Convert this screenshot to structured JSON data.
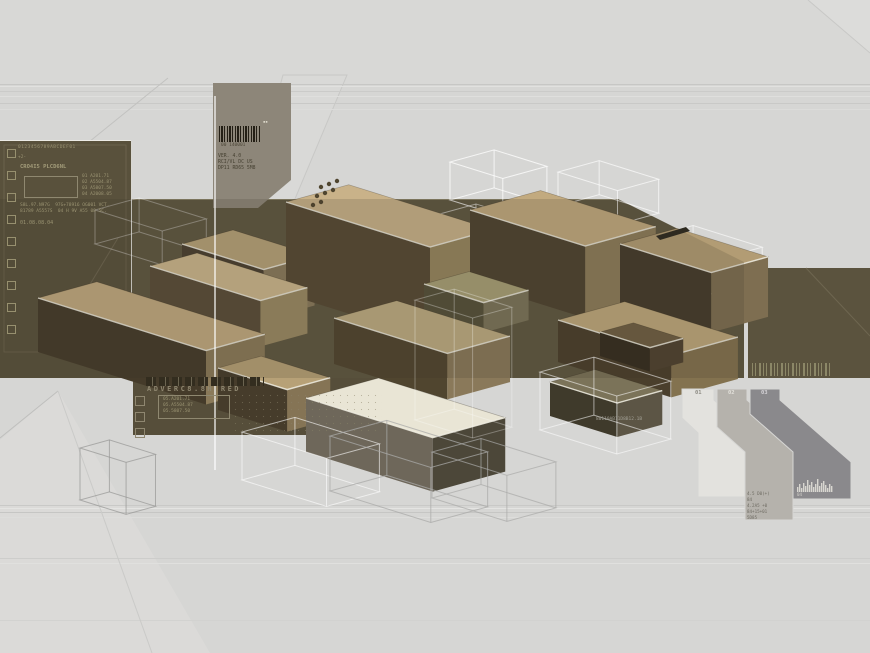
{
  "palette": {
    "background": "#d6d6d4",
    "band_olive": "#5f5741",
    "panel_olive": "#59513c",
    "block_tan": "#c9b289",
    "block_cream": "#e9e5d5",
    "block_front_dark": "#473d2a",
    "annotation_ink": "#9a9372",
    "taupe_box": "#8d8679"
  },
  "left_panel": {
    "digits": "0123456789ABCDEF01",
    "plus": "+2-",
    "title": "CRO4I5 PLCD6NL",
    "diagram_labels": [
      "01 A201.71",
      "02 A5504.87",
      "03 A5807.50",
      "04 A2008.05"
    ],
    "body_line1": "S8L.97.N97G  97G+78916 OG001 VCT.",
    "body_line2": "81789 A5557S  04 H 9V A55 08 5C.",
    "date_code": "01.08.08.04",
    "checkboxes": {
      "x": 7,
      "y": 149,
      "size": 7,
      "gap": 22,
      "count": 9,
      "color": "#97906f"
    }
  },
  "barcode_box": {
    "code": "00 140001",
    "tm_marks": "▪▪",
    "lines": [
      "VER. 4.0",
      "RCI/VL DC US",
      "DP11 RD65 5M8"
    ]
  },
  "lower_panel": {
    "title": "ADVERC8.8H RED",
    "box_lines": [
      "05.A201.71",
      "05.A5504.87",
      "05.5807.50"
    ],
    "checkboxes": {
      "x": 135,
      "y": 396,
      "size": 8,
      "gap": 16,
      "count": 3,
      "color": "#8f8770"
    }
  },
  "serial_text": "80110AB11D8B12.1B",
  "banners": {
    "labels": [
      "01",
      "02",
      "03"
    ],
    "label_colors": [
      "#8f8d85",
      "#e2e0da",
      "#d4d2d6"
    ],
    "text_lines": [
      "4.5 D0(+)",
      "84",
      "4.2A5 +0",
      "84+15+01",
      "5D85"
    ],
    "hist_label": "04"
  },
  "scene": {
    "iso": {
      "ax": 0.96,
      "ay": 0.3,
      "bx": 0.98,
      "by": -0.27
    },
    "top_rect": {
      "pts": [
        [
          0,
          0
        ],
        [
          870,
          0
        ],
        [
          870,
          84
        ],
        [
          0,
          84
        ]
      ],
      "fill": "#d8d8d6"
    },
    "wedges": [
      {
        "pts": [
          [
            0,
            653
          ],
          [
            0,
            440
          ],
          [
            58,
            391
          ],
          [
            210,
            653
          ]
        ],
        "fill": "#dbdad8"
      },
      {
        "pts": [
          [
            808,
            0
          ],
          [
            870,
            0
          ],
          [
            870,
            53
          ]
        ],
        "fill": "#dcdcda"
      },
      {
        "pts": [
          [
            283,
            75
          ],
          [
            347,
            75
          ],
          [
            292,
            206
          ],
          [
            247,
            206
          ]
        ],
        "fill": "#d9d9d7",
        "stroke": "#c8c8c6"
      }
    ],
    "stripes": [
      {
        "y": 84,
        "c": "#c7c7c5"
      },
      {
        "y": 86,
        "c": "#e1e1df"
      },
      {
        "y": 91,
        "c": "#cbcbc9"
      },
      {
        "y": 96,
        "c": "#dfdfdd"
      },
      {
        "y": 103,
        "c": "#c9c9c7"
      },
      {
        "y": 109,
        "c": "#dcdcda"
      },
      {
        "y": 505,
        "c": "#c9c9c7"
      },
      {
        "y": 508,
        "c": "#e4e4e2"
      },
      {
        "y": 512,
        "c": "#c6c6c4"
      },
      {
        "y": 517,
        "c": "#dddddb"
      },
      {
        "y": 558,
        "c": "#cdcdcb"
      },
      {
        "y": 563,
        "c": "#e0e0de"
      },
      {
        "y": 620,
        "c": "#d2d2d0"
      }
    ],
    "lines": [
      {
        "x1": 168,
        "y1": 78,
        "x2": 0,
        "y2": 214,
        "c": "#c2c2c0",
        "w": 1
      },
      {
        "x1": 0,
        "y1": 438,
        "x2": 58,
        "y2": 391,
        "c": "#bfbfbd",
        "w": 1
      },
      {
        "x1": 58,
        "y1": 391,
        "x2": 152,
        "y2": 653,
        "c": "#cacac8",
        "w": 1
      },
      {
        "x1": 808,
        "y1": 0,
        "x2": 870,
        "y2": 53,
        "c": "#c8c8c6",
        "w": 1
      }
    ],
    "left_panel": {
      "x": 0,
      "y": 141,
      "w": 131,
      "h": 237,
      "fill": "#59513c",
      "edge": "#ecebe5",
      "inner": "#6e6650",
      "diag": [
        [
          118,
          238
        ],
        [
          60,
          334
        ]
      ]
    },
    "band": {
      "pts": [
        [
          0,
          199
        ],
        [
          618,
          199
        ],
        [
          744,
          262
        ],
        [
          744,
          378
        ],
        [
          0,
          378
        ]
      ],
      "fill": "#5f5741",
      "top_edge": "#8a8268"
    },
    "lower_panel": {
      "pts": [
        [
          133,
          378
        ],
        [
          430,
          378
        ],
        [
          352,
          435
        ],
        [
          133,
          435
        ]
      ],
      "fill": "#564e3a"
    },
    "right_rect": {
      "x": 748,
      "y": 268,
      "w": 122,
      "h": 110,
      "fill": "#5b533e",
      "diag": [
        [
          806,
          268
        ],
        [
          870,
          336
        ]
      ]
    },
    "barcode_box": {
      "pts": [
        [
          213,
          83
        ],
        [
          291,
          83
        ],
        [
          291,
          180
        ],
        [
          258,
          208
        ],
        [
          213,
          208
        ]
      ],
      "fill": "#8d8679"
    },
    "ghosts_back": [
      {
        "o": [
          450,
          162
        ],
        "a": 55,
        "b": 45,
        "h": 38,
        "c": "rgba(255,255,255,0.75)"
      },
      {
        "o": [
          558,
          172
        ],
        "a": 62,
        "b": 42,
        "h": 34,
        "c": "rgba(255,255,255,0.65)"
      },
      {
        "o": [
          648,
          238
        ],
        "a": 72,
        "b": 46,
        "h": 36,
        "c": "rgba(255,255,255,0.6)"
      },
      {
        "o": [
          425,
          218
        ],
        "a": 75,
        "b": 52,
        "h": 30,
        "c": "rgba(255,255,255,0.55)"
      },
      {
        "o": [
          95,
          210
        ],
        "a": 70,
        "b": 45,
        "h": 34,
        "c": "rgba(255,255,255,0.35)"
      }
    ],
    "blocks": [
      {
        "o": [
          182,
          244
        ],
        "a": 85,
        "b": 52,
        "h": 50,
        "top": "#b7a279",
        "front": "#4a4030",
        "side": "#8a7a5c"
      },
      {
        "o": [
          286,
          202
        ],
        "a": 150,
        "b": 64,
        "h": 92,
        "top": "#c9b289",
        "front": "#564934",
        "side": "#97865f"
      },
      {
        "o": [
          470,
          210
        ],
        "a": 120,
        "b": 72,
        "h": 72,
        "top": "#c2aa7f",
        "front": "#4e4330",
        "side": "#8d7c5a"
      },
      {
        "o": [
          620,
          244
        ],
        "a": 95,
        "b": 58,
        "h": 60,
        "top": "#b29c74",
        "front": "#453b2b",
        "side": "#7e6e51"
      },
      {
        "o": [
          150,
          266
        ],
        "a": 115,
        "b": 48,
        "h": 46,
        "top": "#ccb78d",
        "front": "#5a4d38",
        "side": "#9a8963"
      },
      {
        "o": [
          38,
          298
        ],
        "a": 175,
        "b": 60,
        "h": 54,
        "top": "#c1aa80",
        "front": "#453b2a",
        "side": "#8b7a59"
      },
      {
        "o": [
          424,
          284
        ],
        "a": 62,
        "b": 46,
        "h": 30,
        "top": "#a9a077",
        "front": "#55503a",
        "side": "#7b745a"
      },
      {
        "o": [
          334,
          318
        ],
        "a": 118,
        "b": 64,
        "h": 46,
        "top": "#beac82",
        "front": "#50452f",
        "side": "#8a795a"
      },
      {
        "o": [
          558,
          320
        ],
        "a": 118,
        "b": 68,
        "h": 42,
        "top": "#bfa97d",
        "front": "#4a3f2c",
        "side": "#83724f"
      },
      {
        "o": [
          600,
          332
        ],
        "a": 52,
        "b": 34,
        "h": 24,
        "top": "#6f5f43",
        "front": "#352d1f",
        "side": "#4f4230"
      },
      {
        "o": [
          218,
          368
        ],
        "a": 72,
        "b": 44,
        "h": 42,
        "top": "#b7a177",
        "front": "#463c2b",
        "side": "#857455"
      },
      {
        "o": [
          306,
          398
        ],
        "a": 132,
        "b": 74,
        "h": 54,
        "top": "#e9e5d5",
        "front": "#6e675a",
        "side": "#4c4739"
      },
      {
        "o": [
          550,
          382
        ],
        "a": 70,
        "b": 46,
        "h": 34,
        "top": "#7b7359",
        "front": "#3f3a2b",
        "side": "#5c5545"
      }
    ],
    "dots": {
      "positions": [
        [
          321,
          187
        ],
        [
          329,
          184
        ],
        [
          337,
          181
        ],
        [
          317,
          196
        ],
        [
          325,
          193
        ],
        [
          333,
          190
        ],
        [
          313,
          205
        ],
        [
          321,
          202
        ]
      ],
      "r": 2.2,
      "c": "#4f452f"
    },
    "veil": {
      "pts": [
        [
          0,
          199
        ],
        [
          618,
          199
        ],
        [
          744,
          262
        ],
        [
          744,
          378
        ],
        [
          0,
          378
        ]
      ],
      "fill": "rgba(58,51,36,0.16)"
    },
    "white_line": {
      "x1": 215,
      "y1": 96,
      "x2": 215,
      "y2": 470,
      "c": "rgba(255,255,255,0.8)",
      "w": 1.5
    },
    "ghosts_front": [
      {
        "o": [
          80,
          448
        ],
        "a": 48,
        "b": 30,
        "h": 52,
        "c": "rgba(150,150,148,0.7)"
      },
      {
        "o": [
          242,
          432
        ],
        "a": 88,
        "b": 54,
        "h": 48,
        "c": "rgba(255,255,255,0.6)"
      },
      {
        "o": [
          330,
          436
        ],
        "a": 105,
        "b": 58,
        "h": 55,
        "c": "rgba(170,170,168,0.75)"
      },
      {
        "o": [
          432,
          452
        ],
        "a": 78,
        "b": 50,
        "h": 46,
        "c": "rgba(170,170,168,0.7)"
      },
      {
        "o": [
          540,
          372
        ],
        "a": 80,
        "b": 55,
        "h": 58,
        "c": "rgba(255,255,255,0.55)"
      },
      {
        "o": [
          415,
          300
        ],
        "a": 60,
        "b": 40,
        "h": 120,
        "c": "rgba(255,255,255,0.3)"
      }
    ],
    "banners": [
      {
        "pts": [
          [
            682,
            389
          ],
          [
            714,
            389
          ],
          [
            714,
            400
          ],
          [
            745,
            428
          ],
          [
            745,
            497
          ],
          [
            698,
            497
          ],
          [
            698,
            433
          ],
          [
            682,
            418
          ]
        ],
        "fill": "#e3e2de"
      },
      {
        "pts": [
          [
            717,
            389
          ],
          [
            747,
            389
          ],
          [
            747,
            400
          ],
          [
            793,
            442
          ],
          [
            793,
            520
          ],
          [
            745,
            520
          ],
          [
            745,
            452
          ],
          [
            717,
            427
          ]
        ],
        "fill": "#b5b2ac"
      },
      {
        "pts": [
          [
            750,
            389
          ],
          [
            780,
            389
          ],
          [
            780,
            400
          ],
          [
            851,
            462
          ],
          [
            851,
            499
          ],
          [
            793,
            499
          ],
          [
            793,
            452
          ],
          [
            750,
            414
          ]
        ],
        "fill": "#8a898c"
      }
    ],
    "histogram": {
      "x": 797,
      "base": 492,
      "bw": 2,
      "vals": [
        5,
        8,
        4,
        9,
        6,
        12,
        7,
        10,
        5,
        8,
        13,
        6,
        9,
        11,
        7,
        4,
        8,
        6
      ],
      "c": "#d8d6d0"
    },
    "chip": {
      "pts": [
        [
          656,
          236
        ],
        [
          686,
          227
        ],
        [
          690,
          231
        ],
        [
          660,
          240
        ]
      ],
      "fill": "#2e2a20"
    }
  }
}
